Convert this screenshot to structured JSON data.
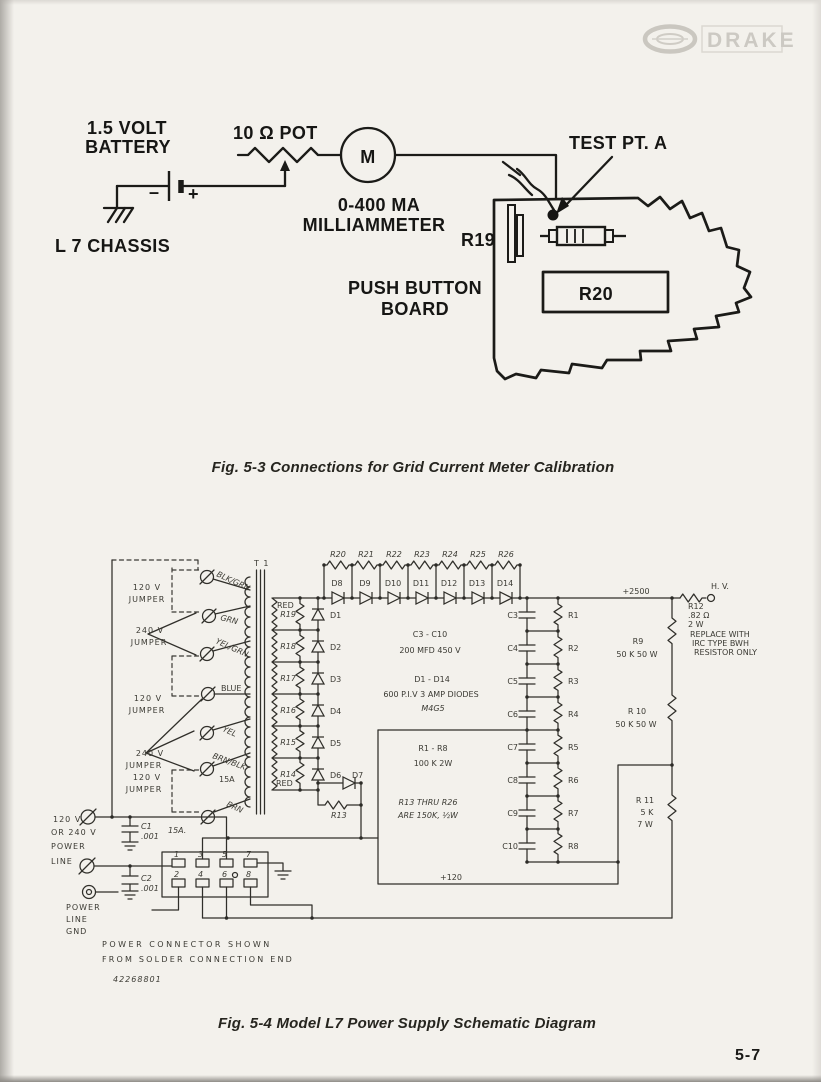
{
  "page": {
    "number": "5-7"
  },
  "brand": {
    "name": "DRAKE"
  },
  "fig53": {
    "caption": "Fig. 5-3  Connections for Grid Current Meter Calibration",
    "battery_label_1": "1.5 VOLT",
    "battery_label_2": "BATTERY",
    "pot_label": "10 Ω POT",
    "meter_symbol": "M",
    "meter_label_1": "0-400 MA",
    "meter_label_2": "MILLIAMMETER",
    "chassis_label": "L 7 CHASSIS",
    "test_point_label": "TEST PT. A",
    "r19_label": "R19",
    "r20_label": "R20",
    "board_label_1": "PUSH BUTTON",
    "board_label_2": "BOARD",
    "minus": "–",
    "plus": "+"
  },
  "fig54": {
    "caption": "Fig. 5-4  Model L7  Power Supply Schematic Diagram",
    "jumpers": [
      {
        "l1": "120 V",
        "l2": "JUMPER"
      },
      {
        "l1": "240 V",
        "l2": "JUMPER"
      },
      {
        "l1": "120 V",
        "l2": "JUMPER"
      },
      {
        "l1": "240 V",
        "l2": "JUMPER"
      },
      {
        "l1": "120 V",
        "l2": "JUMPER"
      }
    ],
    "wires": {
      "blkgrn": "BLK/GRN",
      "grn": "GRN",
      "yelgrn": "YEL/GRN",
      "blue": "BLUE",
      "yel": "YEL",
      "brnblk": "BRN/BLK",
      "brn": "BRN",
      "fuse": "15A",
      "fuse2": "15A."
    },
    "transformer": {
      "name": "T 1",
      "red_top": "RED",
      "red_bottom": "RED",
      "sec_resistors": [
        "R19",
        "R18",
        "R17",
        "R16",
        "R15",
        "R14"
      ]
    },
    "top_resistors": [
      "R20",
      "R21",
      "R22",
      "R23",
      "R24",
      "R25",
      "R26"
    ],
    "top_diodes": [
      "D8",
      "D9",
      "D10",
      "D11",
      "D12",
      "D13",
      "D14"
    ],
    "left_diodes": [
      "D1",
      "D2",
      "D3",
      "D4",
      "D5",
      "D6"
    ],
    "d7": "D7",
    "r13": "R13",
    "caps": [
      "C3",
      "C4",
      "C5",
      "C6",
      "C7",
      "C8",
      "C9",
      "C10"
    ],
    "bleeders": [
      "R1",
      "R2",
      "R3",
      "R4",
      "R5",
      "R6",
      "R7",
      "R8"
    ],
    "notes": {
      "caps_1": "C3 - C10",
      "caps_2": "200 MFD   450 V",
      "diodes_1": "D1 - D14",
      "diodes_2": "600 P.I.V  3 AMP DIODES",
      "diodes_3": "M4G5",
      "bleeder_1": "R1 - R8",
      "bleeder_2": "100 K   2W",
      "r13_1": "R13 THRU R26",
      "r13_2": "ARE 150K, ½W"
    },
    "r9": {
      "name": "R9",
      "value": "50 K  50 W"
    },
    "r10": {
      "name": "R 10",
      "value": "50 K  50 W"
    },
    "r11": {
      "name": "R 11",
      "v1": "5 K",
      "v2": "7 W"
    },
    "r12": {
      "lines": [
        "R12",
        ".82 Ω",
        "2 W",
        "REPLACE WITH",
        "IRC TYPE BWH",
        "RESISTOR ONLY"
      ]
    },
    "rails": {
      "hv_plus": "+2500",
      "hv": "H. V.",
      "plus120": "+120"
    },
    "power": {
      "l1": "120 V",
      "l2": "OR  240 V",
      "l3": "POWER",
      "l4": "LINE",
      "gnd1": "POWER",
      "gnd2": "LINE",
      "gnd3": "GND",
      "c1": "C1",
      "c1v": ".001",
      "c2": "C2",
      "c2v": ".001"
    },
    "connector": {
      "pins": [
        "1",
        "2",
        "3",
        "4",
        "5",
        "6",
        "7",
        "8"
      ],
      "note_1": "POWER   CONNECTOR   SHOWN",
      "note_2": "FROM  SOLDER  CONNECTION  END",
      "part": "42268801"
    }
  }
}
